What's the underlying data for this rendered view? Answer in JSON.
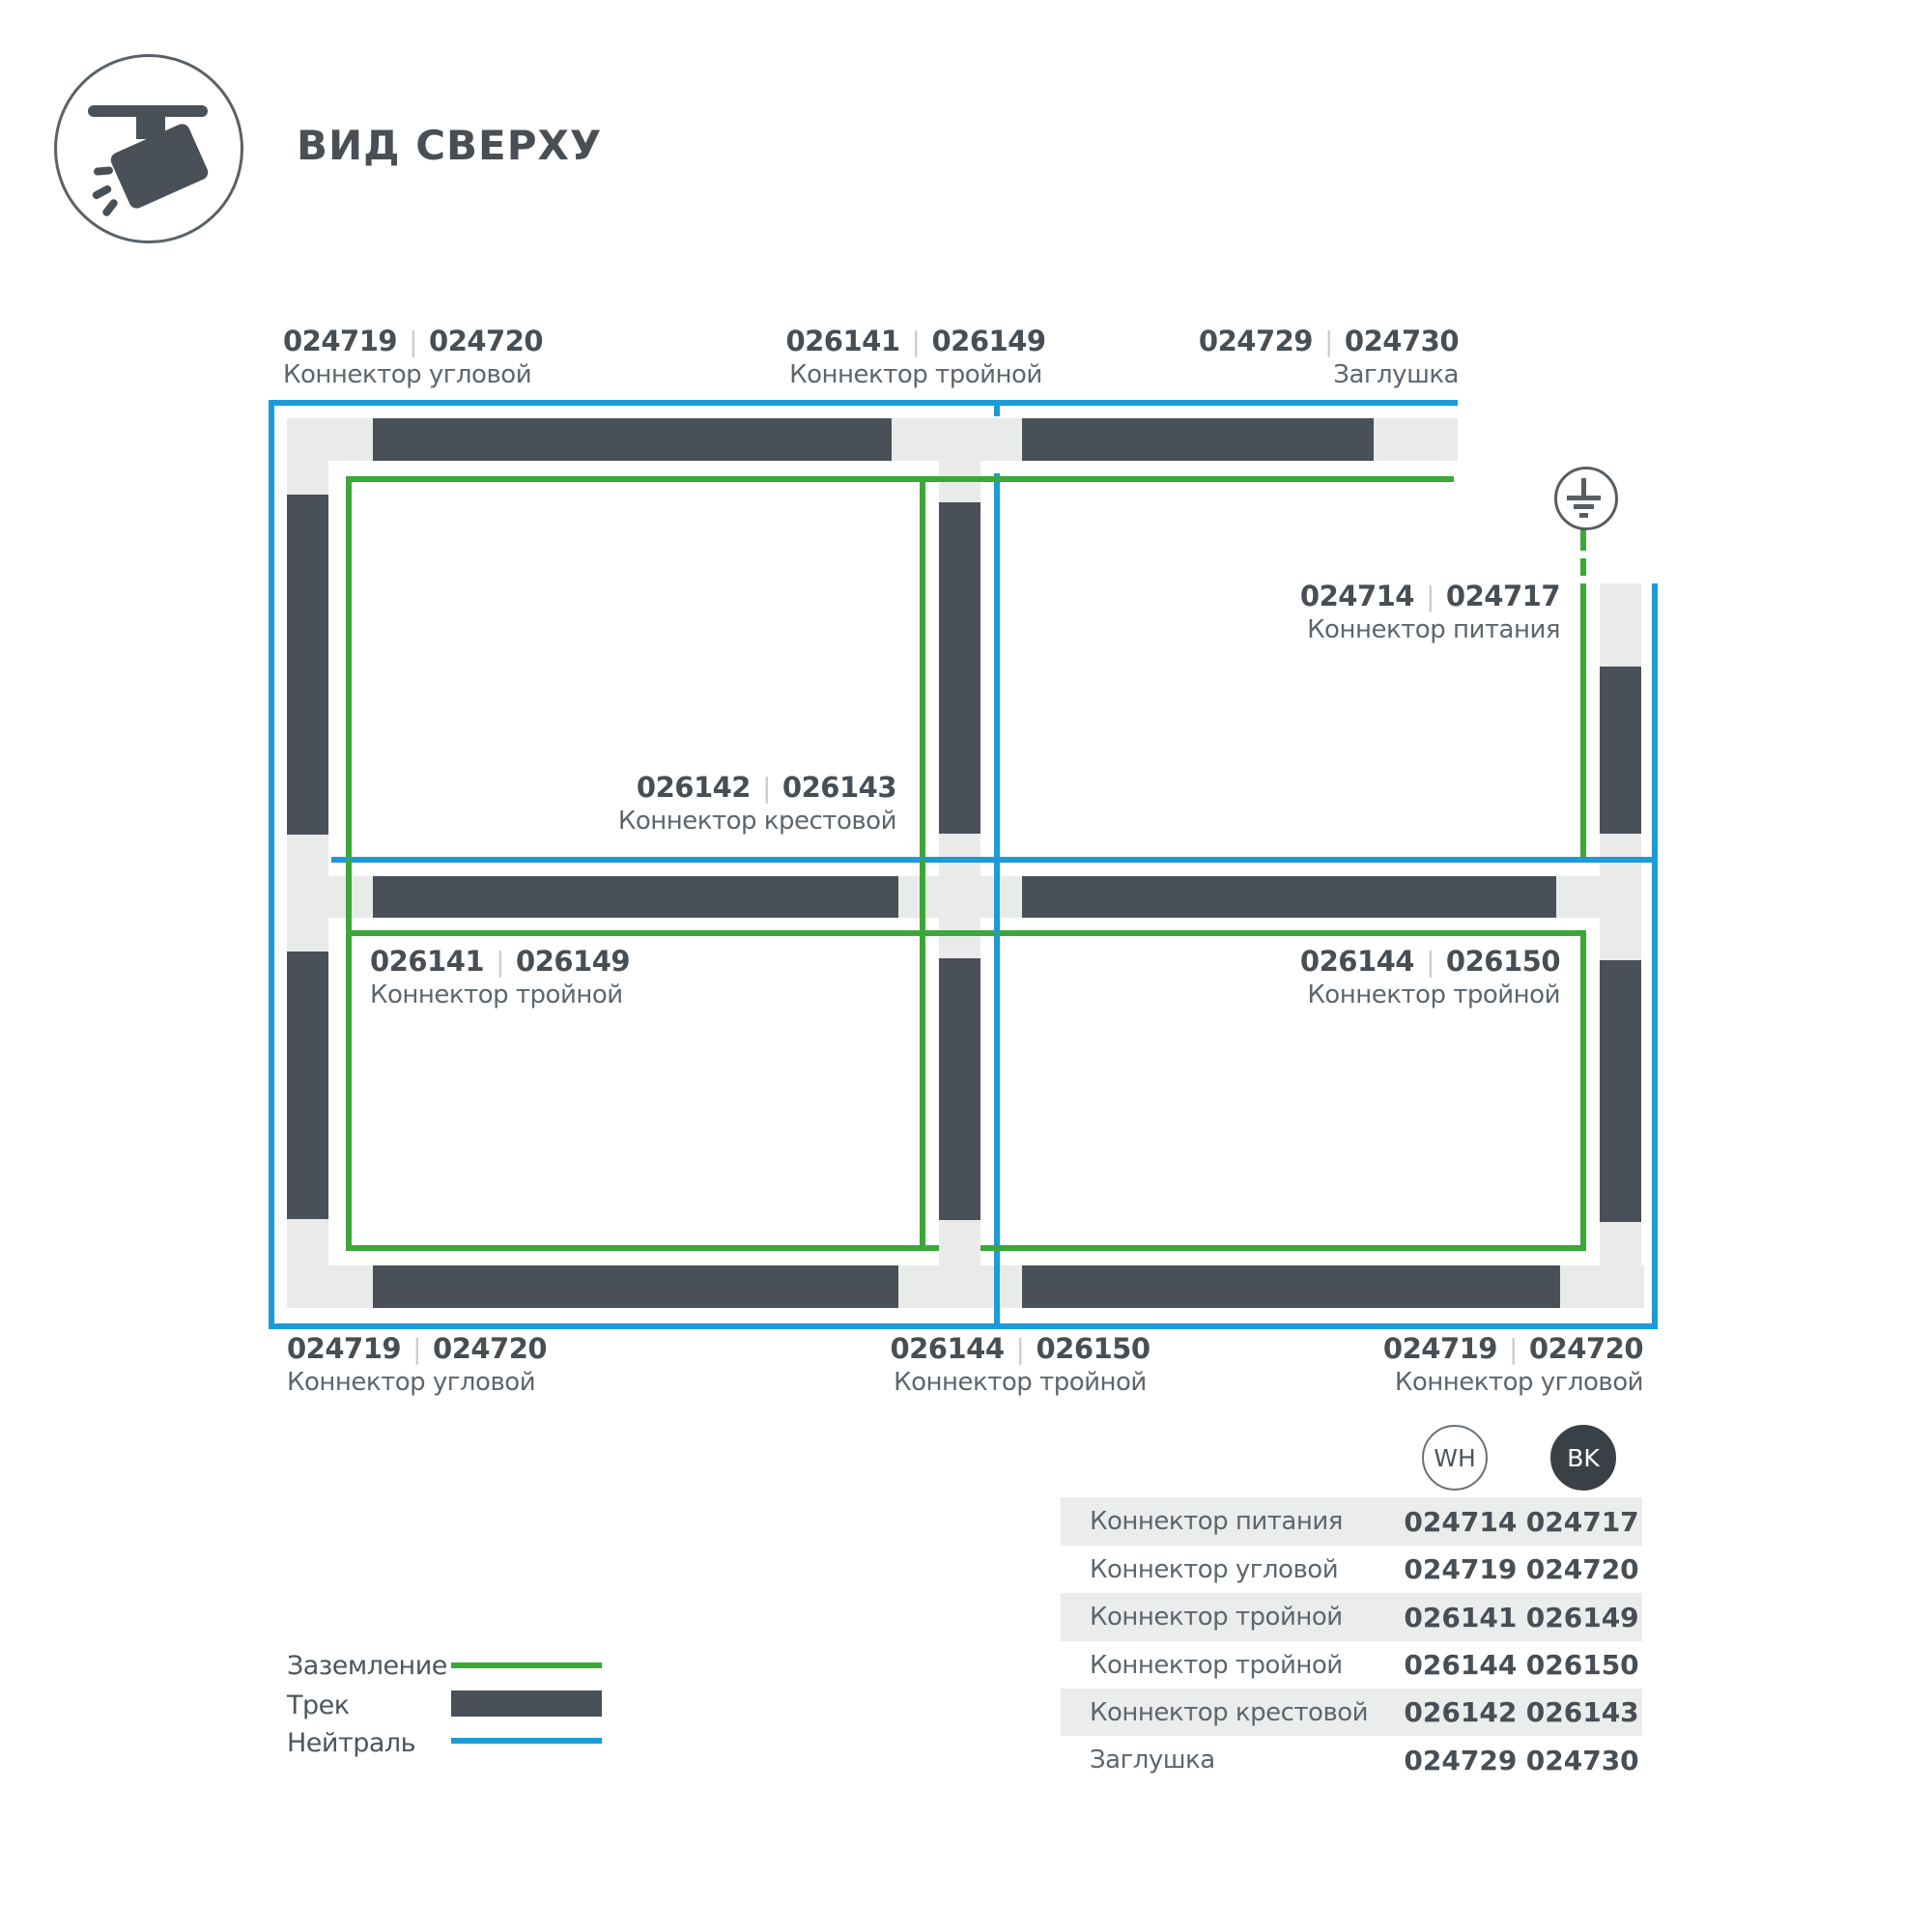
{
  "header": {
    "title": "ВИД СВЕРХУ",
    "icon": "track-spotlight-icon"
  },
  "colors": {
    "track": "#495057",
    "ground_green": "#3BA838",
    "neutral_blue": "#1C9BD8",
    "connector_gray": "#E9EAEA",
    "row_shade": "#EBECEC",
    "text_dark": "#474E54",
    "text_gray": "#5D666D",
    "separator_gray": "#C9CDCE"
  },
  "diagram": {
    "separator": "|",
    "ground_symbol": "earth-ground-icon",
    "labels": [
      {
        "id": "top-left",
        "wh": "024719",
        "bk": "024720",
        "caption": "Коннектор угловой"
      },
      {
        "id": "top-middle",
        "wh": "026141",
        "bk": "026149",
        "caption": "Коннектор тройной"
      },
      {
        "id": "top-right",
        "wh": "024729",
        "bk": "024730",
        "caption": "Заглушка"
      },
      {
        "id": "power",
        "wh": "024714",
        "bk": "024717",
        "caption": "Коннектор питания"
      },
      {
        "id": "cross",
        "wh": "026142",
        "bk": "026143",
        "caption": "Коннектор крестовой"
      },
      {
        "id": "mid-left",
        "wh": "026141",
        "bk": "026149",
        "caption": "Коннектор тройной"
      },
      {
        "id": "mid-right",
        "wh": "026144",
        "bk": "026150",
        "caption": "Коннектор тройной"
      },
      {
        "id": "bottom-left",
        "wh": "024719",
        "bk": "024720",
        "caption": "Коннектор угловой"
      },
      {
        "id": "bottom-middle",
        "wh": "026144",
        "bk": "026150",
        "caption": "Коннектор тройной"
      },
      {
        "id": "bottom-right",
        "wh": "024719",
        "bk": "024720",
        "caption": "Коннектор угловой"
      }
    ]
  },
  "legend": {
    "items": [
      {
        "label": "Заземление",
        "swatch": "green-line"
      },
      {
        "label": "Трек",
        "swatch": "track-bar"
      },
      {
        "label": "Нейтраль",
        "swatch": "blue-line"
      }
    ]
  },
  "table": {
    "header": {
      "wh": "WH",
      "bk": "BK"
    },
    "rows": [
      {
        "name": "Коннектор питания",
        "wh": "024714",
        "bk": "024717"
      },
      {
        "name": "Коннектор угловой",
        "wh": "024719",
        "bk": "024720"
      },
      {
        "name": "Коннектор тройной",
        "wh": "026141",
        "bk": "026149"
      },
      {
        "name": "Коннектор тройной",
        "wh": "026144",
        "bk": "026150"
      },
      {
        "name": "Коннектор крестовой",
        "wh": "026142",
        "bk": "026143"
      },
      {
        "name": "Заглушка",
        "wh": "024729",
        "bk": "024730"
      }
    ]
  }
}
